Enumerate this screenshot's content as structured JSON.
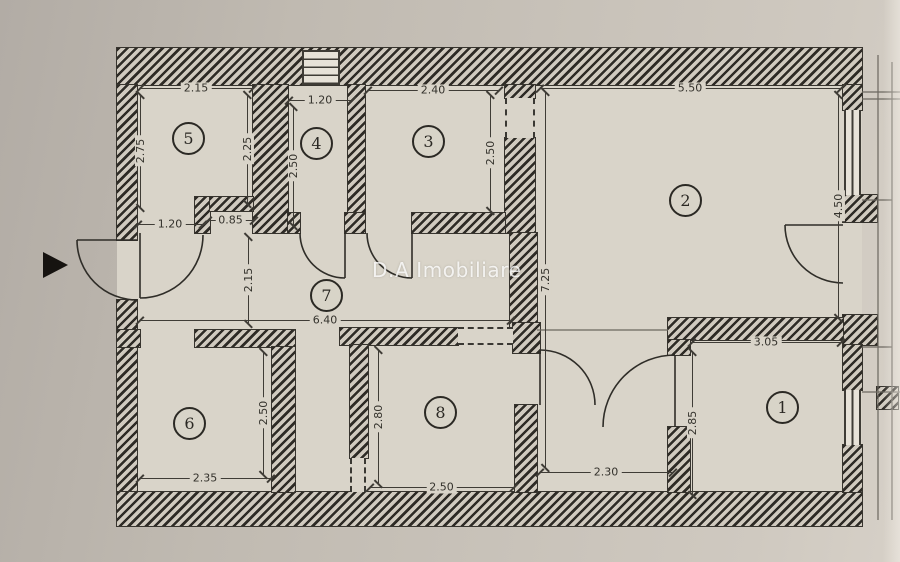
{
  "watermark": "D.A Imobiliare",
  "rooms": {
    "r1": {
      "number": "1"
    },
    "r2": {
      "number": "2"
    },
    "r3": {
      "number": "3"
    },
    "r4": {
      "number": "4"
    },
    "r5": {
      "number": "5"
    },
    "r6": {
      "number": "6"
    },
    "r7": {
      "number": "7"
    },
    "r8": {
      "number": "8"
    }
  },
  "dimensions": {
    "room5_width": "2.15",
    "room5_height_left": "2.75",
    "room5_height_right": "2.25",
    "room4_width": "1.20",
    "room4_height": "2.50",
    "room3_width": "2.40",
    "room3_height": "2.50",
    "room2_width": "5.50",
    "room2_height": "4.50",
    "apartment_height": "7.25",
    "room5_door_width": "1.20",
    "nook_width": "0.85",
    "hall_width": "6.40",
    "hall_height": "2.15",
    "room6_width": "2.35",
    "room6_height": "2.50",
    "room8_width": "2.50",
    "room8_height": "2.80",
    "room2_lower_width": "2.30",
    "room1_width": "3.05",
    "room1_height": "2.85"
  },
  "colors": {
    "paper": "#c6c0b7",
    "wall_dark": "#2e2b26",
    "floor": "#d9d4c9",
    "watermark_text": "#ffffff"
  }
}
